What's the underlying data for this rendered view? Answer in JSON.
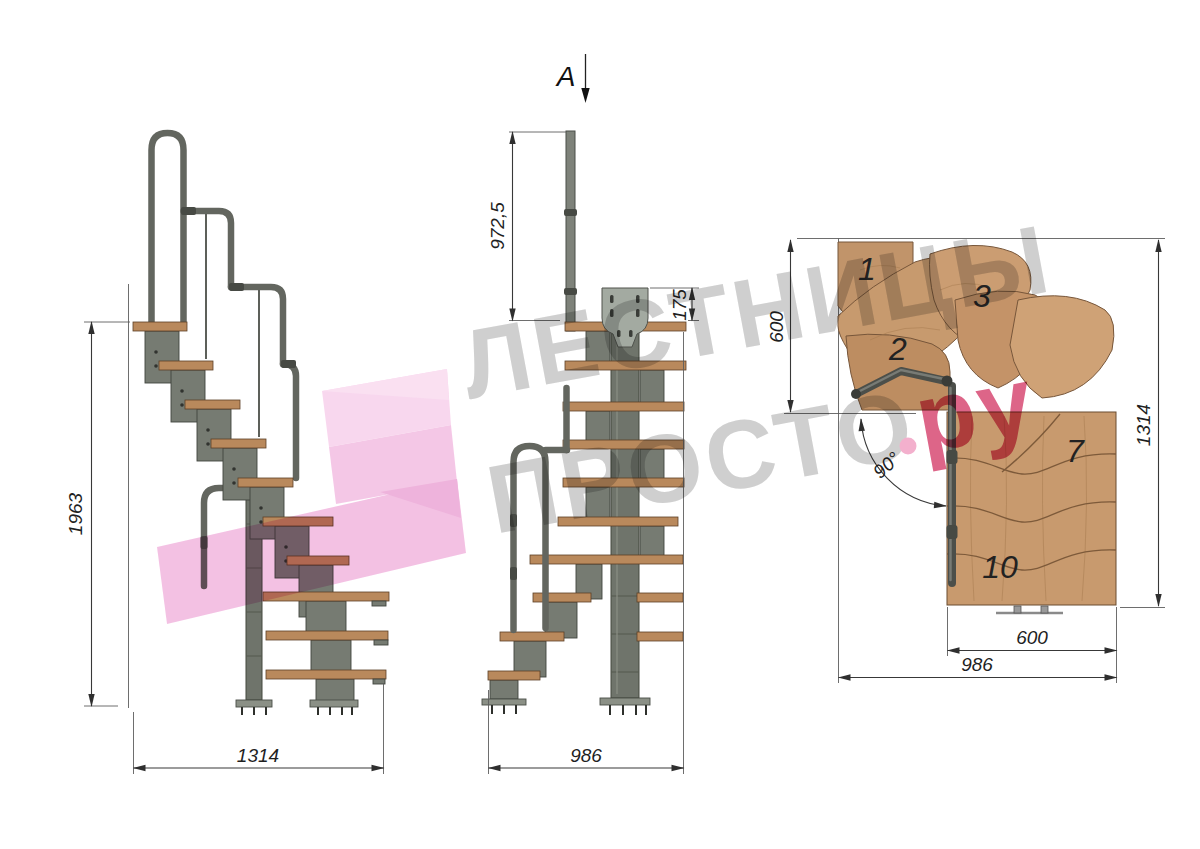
{
  "watermark": {
    "line1": "\u041b\u0415\u0421\u0422\u041d\u0418\u0426\u042b",
    "line2": "\u041f\u0420\u041e\u0421\u0422\u041e",
    "suffix": "\u0440\u0443",
    "gray_color": "#c9c9c9",
    "pink_color": "#d94f78",
    "dot_color": "#f2a5c6",
    "logo_pink": "#f3c0e3"
  },
  "section_marker": {
    "label": "A"
  },
  "side_view": {
    "height_mm": "1963",
    "width_mm": "1314"
  },
  "front_view": {
    "rail_height_mm": "972,5",
    "plate_mm": "175",
    "width_mm": "986"
  },
  "plan_view": {
    "top_depth_mm": "600",
    "side_length_mm": "1314",
    "run_width_mm": "600",
    "total_width_mm": "986",
    "turn_angle": "90\u00b0",
    "step_numbers": [
      "1",
      "2",
      "3",
      "7",
      "10"
    ]
  },
  "colors": {
    "wood_plan": "#c89a6e",
    "wood_tread": "#b9895c",
    "metal": "#767b72",
    "rail": "#63665f",
    "line": "#383838"
  }
}
